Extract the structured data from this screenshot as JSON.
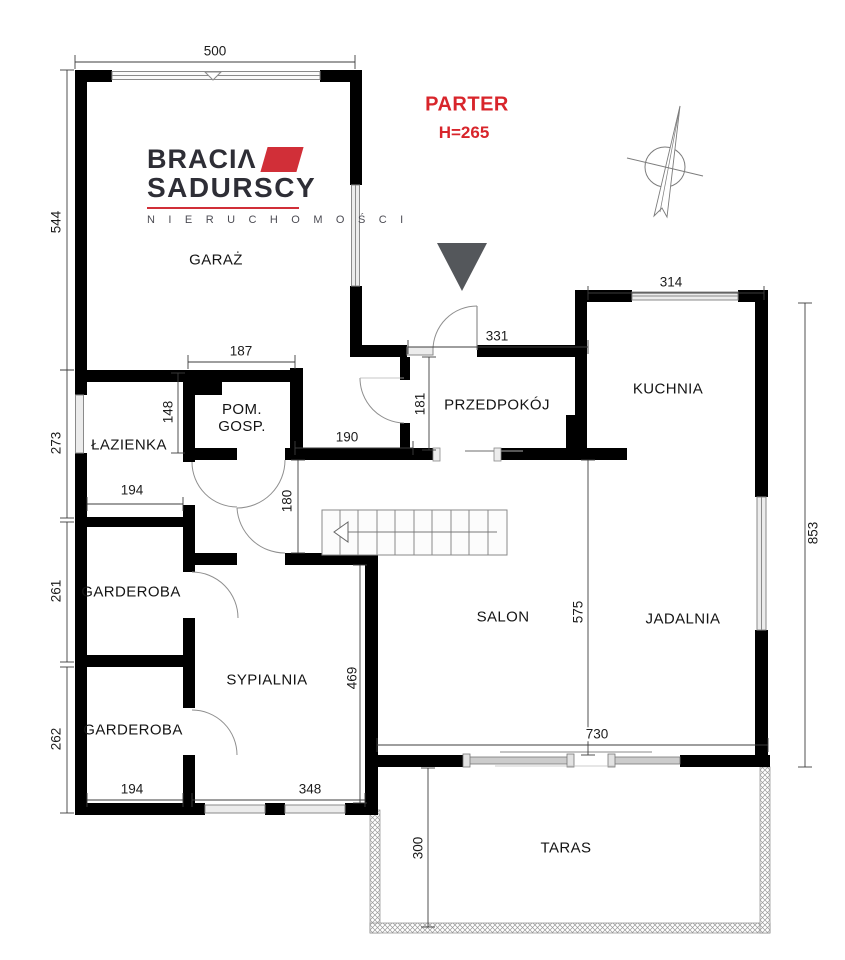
{
  "title": {
    "main": "PARTER",
    "height": "H=265"
  },
  "logo": {
    "line1": "BRACIΛ",
    "line2": "SADURSCY",
    "line3": "N I E R U C H O M O Ś C I"
  },
  "colors": {
    "wall": "#000000",
    "accent_red": "#d8252b",
    "logo_red": "#d12f38",
    "logo_dark": "#2e2e36",
    "entrance_marker": "#54575b",
    "thin_line": "#8a8a8a",
    "window_fill": "#ececec"
  },
  "rooms": [
    {
      "name": "GARAŻ",
      "x": 216,
      "y": 260
    },
    {
      "name": "ŁAZIENKA",
      "x": 129,
      "y": 445
    },
    {
      "name": "POM.\nGOSP.",
      "x": 242,
      "y": 418
    },
    {
      "name": "PRZEDPOKÓJ",
      "x": 497,
      "y": 405
    },
    {
      "name": "KUCHNIA",
      "x": 668,
      "y": 389
    },
    {
      "name": "GARDEROBA",
      "x": 131,
      "y": 592
    },
    {
      "name": "SYPIALNIA",
      "x": 267,
      "y": 680
    },
    {
      "name": "GARDEROBA",
      "x": 133,
      "y": 730
    },
    {
      "name": "SALON",
      "x": 503,
      "y": 617
    },
    {
      "name": "JADALNIA",
      "x": 683,
      "y": 619
    },
    {
      "name": "TARAS",
      "x": 566,
      "y": 848
    }
  ],
  "dimensions": [
    {
      "label": "500",
      "lx": 215,
      "ly": 51,
      "rot": false,
      "x1": 75,
      "y1": 62,
      "x2": 355,
      "y2": 62
    },
    {
      "label": "544",
      "lx": 56,
      "ly": 222,
      "rot": true,
      "x1": 67,
      "y1": 70,
      "x2": 67,
      "y2": 370
    },
    {
      "label": "273",
      "lx": 56,
      "ly": 443,
      "rot": true,
      "x1": 67,
      "y1": 370,
      "x2": 67,
      "y2": 518
    },
    {
      "label": "261",
      "lx": 56,
      "ly": 591,
      "rot": true,
      "x1": 67,
      "y1": 522,
      "x2": 67,
      "y2": 662
    },
    {
      "label": "262",
      "lx": 56,
      "ly": 739,
      "rot": true,
      "x1": 67,
      "y1": 667,
      "x2": 67,
      "y2": 813
    },
    {
      "label": "194",
      "lx": 132,
      "ly": 490,
      "rot": false,
      "x1": 87,
      "y1": 504,
      "x2": 183,
      "y2": 504
    },
    {
      "label": "148",
      "lx": 168,
      "ly": 412,
      "rot": true,
      "x1": 178,
      "y1": 373,
      "x2": 178,
      "y2": 453
    },
    {
      "label": "187",
      "lx": 241,
      "ly": 351,
      "rot": false,
      "x1": 188,
      "y1": 362,
      "x2": 295,
      "y2": 362
    },
    {
      "label": "190",
      "lx": 347,
      "ly": 437,
      "rot": false,
      "x1": 295,
      "y1": 448,
      "x2": 413,
      "y2": 448
    },
    {
      "label": "181",
      "lx": 420,
      "ly": 404,
      "rot": true,
      "x1": 429,
      "y1": 357,
      "x2": 429,
      "y2": 450
    },
    {
      "label": "331",
      "lx": 497,
      "ly": 336,
      "rot": false,
      "x1": 408,
      "y1": 347,
      "x2": 588,
      "y2": 347
    },
    {
      "label": "314",
      "lx": 671,
      "ly": 282,
      "rot": false,
      "x1": 588,
      "y1": 293,
      "x2": 764,
      "y2": 293
    },
    {
      "label": "180",
      "lx": 287,
      "ly": 501,
      "rot": true,
      "x1": 298,
      "y1": 460,
      "x2": 298,
      "y2": 553
    },
    {
      "label": "575",
      "lx": 578,
      "ly": 612,
      "rot": true,
      "x1": 588,
      "y1": 460,
      "x2": 588,
      "y2": 755
    },
    {
      "label": "469",
      "lx": 352,
      "ly": 678,
      "rot": true,
      "x1": 360,
      "y1": 565,
      "x2": 360,
      "y2": 803
    },
    {
      "label": "853",
      "lx": 813,
      "ly": 533,
      "rot": true,
      "x1": 805,
      "y1": 303,
      "x2": 805,
      "y2": 767
    },
    {
      "label": "730",
      "lx": 597,
      "ly": 734,
      "rot": false,
      "x1": 377,
      "y1": 745,
      "x2": 768,
      "y2": 745
    },
    {
      "label": "194",
      "lx": 132,
      "ly": 789,
      "rot": false,
      "x1": 87,
      "y1": 800,
      "x2": 183,
      "y2": 800
    },
    {
      "label": "348",
      "lx": 310,
      "ly": 789,
      "rot": false,
      "x1": 192,
      "y1": 800,
      "x2": 365,
      "y2": 800
    },
    {
      "label": "300",
      "lx": 418,
      "ly": 848,
      "rot": true,
      "x1": 428,
      "y1": 768,
      "x2": 428,
      "y2": 927
    }
  ]
}
